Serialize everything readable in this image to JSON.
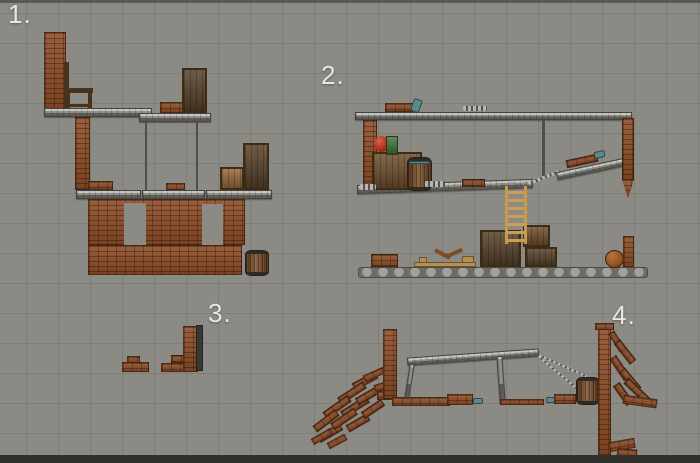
{
  "colors": {
    "background": "#8b8a85",
    "grid_line": "#807e78",
    "label_text": "#e9e7e3",
    "brick": "#8e4d27",
    "metal": "#8f8d88",
    "wood_crate": "#6f4f2d",
    "barrel_wood": "#7b4e28",
    "ladder_wood": "#c59a4e",
    "ball": "#96521f",
    "apple_red": "#a32517",
    "box_green": "#3e6c34",
    "teal_item": "#5b8a8d",
    "bottom_bar": "#32302c"
  },
  "scenes": [
    {
      "label": "1.",
      "objects": [
        {
          "t": "brick",
          "n": "brick-column",
          "x": 44,
          "y": 32,
          "w": 22,
          "h": 77
        },
        {
          "t": "chairwood",
          "n": "chair-back",
          "x": 64,
          "y": 62,
          "w": 5,
          "h": 47
        },
        {
          "t": "chairwood",
          "n": "chair-seat",
          "x": 64,
          "y": 88,
          "w": 29,
          "h": 5
        },
        {
          "t": "chairwood",
          "n": "chair-rear-leg",
          "x": 66,
          "y": 93,
          "w": 4,
          "h": 15
        },
        {
          "t": "chairwood",
          "n": "chair-front-leg",
          "x": 88,
          "y": 93,
          "w": 4,
          "h": 16
        },
        {
          "t": "chairwood",
          "n": "chair-stretcher",
          "x": 66,
          "y": 104,
          "w": 25,
          "h": 3
        },
        {
          "t": "platform",
          "n": "upper-platform-left",
          "x": 44,
          "y": 108,
          "w": 108,
          "h": 9
        },
        {
          "t": "platform",
          "n": "upper-platform-right",
          "x": 139,
          "y": 113,
          "w": 72,
          "h": 9
        },
        {
          "t": "brick",
          "n": "brick-stack",
          "x": 160,
          "y": 102,
          "w": 23,
          "h": 11
        },
        {
          "t": "crate",
          "v": "dark",
          "n": "tall-crate",
          "x": 182,
          "y": 68,
          "w": 25,
          "h": 45
        },
        {
          "t": "rope",
          "n": "hanging-rope",
          "x": 145,
          "y": 122,
          "w": 2,
          "h": 68
        },
        {
          "t": "rope",
          "n": "hanging-rope",
          "x": 196,
          "y": 122,
          "w": 2,
          "h": 68
        },
        {
          "t": "brick",
          "n": "brick-pillar",
          "x": 75,
          "y": 117,
          "w": 15,
          "h": 73
        },
        {
          "t": "brick",
          "n": "brick-arch",
          "x": 88,
          "y": 181,
          "w": 25,
          "h": 9
        },
        {
          "t": "brick",
          "n": "brick-arch",
          "x": 166,
          "y": 183,
          "w": 19,
          "h": 7
        },
        {
          "t": "platform",
          "n": "mid-platform",
          "x": 76,
          "y": 190,
          "w": 65,
          "h": 9
        },
        {
          "t": "platform",
          "n": "mid-platform",
          "x": 142,
          "y": 190,
          "w": 63,
          "h": 9
        },
        {
          "t": "platform",
          "n": "mid-platform",
          "x": 206,
          "y": 190,
          "w": 66,
          "h": 9
        },
        {
          "t": "crate",
          "v": "tan",
          "n": "crate",
          "x": 220,
          "y": 167,
          "w": 24,
          "h": 23
        },
        {
          "t": "crate",
          "v": "dark",
          "n": "crate",
          "x": 243,
          "y": 143,
          "w": 26,
          "h": 47
        },
        {
          "t": "brick",
          "n": "brick-wall",
          "x": 88,
          "y": 199,
          "w": 157,
          "h": 46
        },
        {
          "t": "window",
          "n": "window-opening",
          "x": 124,
          "y": 203,
          "w": 22,
          "h": 42
        },
        {
          "t": "window",
          "n": "window-opening",
          "x": 202,
          "y": 204,
          "w": 21,
          "h": 41
        },
        {
          "t": "brick",
          "n": "brick-wall-base",
          "x": 88,
          "y": 245,
          "w": 154,
          "h": 30
        },
        {
          "t": "barrel",
          "n": "barrel",
          "x": 245,
          "y": 250,
          "w": 24,
          "h": 26
        }
      ]
    },
    {
      "label": "2.",
      "objects": [
        {
          "t": "platform",
          "n": "top-beam",
          "x": 355,
          "y": 112,
          "w": 277,
          "h": 8
        },
        {
          "t": "brick",
          "n": "brick-stack",
          "x": 385,
          "y": 103,
          "w": 28,
          "h": 9
        },
        {
          "t": "teal",
          "n": "bottle",
          "x": 412,
          "y": 99,
          "w": 9,
          "h": 13,
          "r": 20
        },
        {
          "t": "chain",
          "n": "chain",
          "x": 463,
          "y": 106,
          "w": 24,
          "h": 5
        },
        {
          "t": "brick",
          "n": "hanging-brick-column",
          "x": 363,
          "y": 120,
          "w": 14,
          "h": 69
        },
        {
          "t": "rope",
          "n": "hanging-rope",
          "x": 542,
          "y": 120,
          "w": 3,
          "h": 56
        },
        {
          "t": "platform",
          "n": "shelf-beam",
          "x": 357,
          "y": 182,
          "w": 176,
          "h": 9,
          "r": -2
        },
        {
          "t": "crate",
          "n": "crate-large",
          "x": 372,
          "y": 152,
          "w": 50,
          "h": 38
        },
        {
          "t": "barrel",
          "n": "barrel",
          "x": 407,
          "y": 157,
          "w": 25,
          "h": 34
        },
        {
          "t": "teal",
          "n": "barrel-band",
          "x": 409,
          "y": 161,
          "w": 21,
          "h": 3
        },
        {
          "t": "apple",
          "n": "apple",
          "x": 374,
          "y": 136,
          "w": 15,
          "h": 16
        },
        {
          "t": "greenbox",
          "n": "green-box",
          "x": 386,
          "y": 136,
          "w": 12,
          "h": 19
        },
        {
          "t": "brick",
          "n": "brick-stack",
          "x": 462,
          "y": 179,
          "w": 23,
          "h": 8
        },
        {
          "t": "chain",
          "n": "chain",
          "x": 360,
          "y": 184,
          "w": 16,
          "h": 6
        },
        {
          "t": "chain",
          "n": "chain",
          "x": 425,
          "y": 181,
          "w": 20,
          "h": 6
        },
        {
          "t": "chain",
          "n": "chain-link",
          "x": 527,
          "y": 176,
          "w": 34,
          "h": 3,
          "r": -22
        },
        {
          "t": "platform",
          "n": "ramp-beam",
          "x": 556,
          "y": 165,
          "w": 70,
          "h": 8,
          "r": -12
        },
        {
          "t": "brick",
          "n": "ramp-bricks",
          "x": 566,
          "y": 157,
          "w": 32,
          "h": 8,
          "r": -12
        },
        {
          "t": "teal",
          "n": "bottle",
          "x": 594,
          "y": 151,
          "w": 11,
          "h": 7,
          "r": -12
        },
        {
          "t": "brick",
          "n": "hanging-brick-column",
          "x": 622,
          "y": 118,
          "w": 12,
          "h": 62
        },
        {
          "t": "tip",
          "n": "brick-tip",
          "x": 622,
          "y": 180,
          "w": 12,
          "h": 18
        },
        {
          "t": "stone",
          "n": "ground",
          "x": 358,
          "y": 267,
          "w": 290,
          "h": 11
        },
        {
          "t": "brick",
          "n": "brick-stack",
          "x": 371,
          "y": 254,
          "w": 27,
          "h": 13
        },
        {
          "t": "wood",
          "n": "plank",
          "x": 414,
          "y": 262,
          "w": 62,
          "h": 5
        },
        {
          "t": "stick",
          "n": "wood-stick",
          "x": 434,
          "y": 252,
          "w": 17,
          "h": 4,
          "r": 28
        },
        {
          "t": "stick",
          "n": "wood-stick",
          "x": 446,
          "y": 251,
          "w": 17,
          "h": 4,
          "r": -24
        },
        {
          "t": "wood",
          "n": "small-box",
          "x": 462,
          "y": 256,
          "w": 12,
          "h": 7
        },
        {
          "t": "wood",
          "n": "small-box",
          "x": 419,
          "y": 257,
          "w": 8,
          "h": 6
        },
        {
          "t": "crate",
          "v": "dark",
          "n": "crate",
          "x": 480,
          "y": 230,
          "w": 41,
          "h": 37
        },
        {
          "t": "crate",
          "n": "crate",
          "x": 523,
          "y": 225,
          "w": 27,
          "h": 22
        },
        {
          "t": "crate",
          "v": "dark",
          "n": "crate",
          "x": 525,
          "y": 247,
          "w": 32,
          "h": 20
        },
        {
          "t": "ladder",
          "n": "ladder",
          "x": 505,
          "y": 186,
          "w": 22,
          "h": 58
        },
        {
          "t": "ball",
          "n": "ball",
          "x": 605,
          "y": 250,
          "w": 19,
          "h": 18
        },
        {
          "t": "brick",
          "n": "brick-column",
          "x": 623,
          "y": 236,
          "w": 11,
          "h": 31
        }
      ]
    },
    {
      "label": "3.",
      "objects": [
        {
          "t": "brick",
          "n": "brick-rubble",
          "x": 122,
          "y": 362,
          "w": 27,
          "h": 10
        },
        {
          "t": "brick",
          "n": "brick-rubble",
          "x": 127,
          "y": 356,
          "w": 13,
          "h": 7
        },
        {
          "t": "brick",
          "n": "brick-base",
          "x": 161,
          "y": 363,
          "w": 37,
          "h": 9
        },
        {
          "t": "brick",
          "n": "brick-step",
          "x": 171,
          "y": 355,
          "w": 26,
          "h": 8
        },
        {
          "t": "brick",
          "n": "brick-column",
          "x": 183,
          "y": 326,
          "w": 14,
          "h": 46
        },
        {
          "t": "metalbar",
          "n": "metal-beam",
          "x": 196,
          "y": 325,
          "w": 7,
          "h": 46
        }
      ]
    },
    {
      "label": "4.",
      "objects": [
        {
          "t": "brick",
          "n": "rubble-brick",
          "x": 352,
          "y": 377,
          "w": 26,
          "h": 8,
          "r": -28
        },
        {
          "t": "brick",
          "n": "rubble-brick",
          "x": 337,
          "y": 389,
          "w": 30,
          "h": 8,
          "r": -33
        },
        {
          "t": "brick",
          "n": "rubble-brick",
          "x": 322,
          "y": 403,
          "w": 30,
          "h": 8,
          "r": -35
        },
        {
          "t": "brick",
          "n": "rubble-brick",
          "x": 312,
          "y": 417,
          "w": 28,
          "h": 8,
          "r": -37
        },
        {
          "t": "brick",
          "n": "rubble-brick",
          "x": 317,
          "y": 429,
          "w": 26,
          "h": 8,
          "r": -30
        },
        {
          "t": "brick",
          "n": "rubble-brick",
          "x": 340,
          "y": 403,
          "w": 30,
          "h": 8,
          "r": -32
        },
        {
          "t": "brick",
          "n": "rubble-brick",
          "x": 355,
          "y": 391,
          "w": 28,
          "h": 8,
          "r": -30
        },
        {
          "t": "brick",
          "n": "rubble-brick",
          "x": 330,
          "y": 415,
          "w": 28,
          "h": 8,
          "r": -34
        },
        {
          "t": "brick",
          "n": "rubble-brick",
          "x": 346,
          "y": 419,
          "w": 24,
          "h": 8,
          "r": -30
        },
        {
          "t": "brick",
          "n": "rubble-brick",
          "x": 361,
          "y": 405,
          "w": 24,
          "h": 8,
          "r": -34
        },
        {
          "t": "brick",
          "n": "rubble-brick",
          "x": 311,
          "y": 433,
          "w": 22,
          "h": 7,
          "r": -30
        },
        {
          "t": "brick",
          "n": "rubble-brick",
          "x": 327,
          "y": 438,
          "w": 20,
          "h": 7,
          "r": -28
        },
        {
          "t": "brick",
          "n": "rubble-brick",
          "x": 363,
          "y": 371,
          "w": 22,
          "h": 7,
          "r": -24
        },
        {
          "t": "brick",
          "n": "rubble-brick",
          "x": 374,
          "y": 382,
          "w": 20,
          "h": 7,
          "r": -18
        },
        {
          "t": "brick",
          "n": "tower-base",
          "x": 377,
          "y": 391,
          "w": 20,
          "h": 9
        },
        {
          "t": "brick",
          "n": "brick-tower",
          "x": 383,
          "y": 329,
          "w": 14,
          "h": 70
        },
        {
          "t": "brick",
          "n": "ground-bricks",
          "x": 392,
          "y": 397,
          "w": 58,
          "h": 9
        },
        {
          "t": "brick",
          "n": "ground-bricks",
          "x": 447,
          "y": 394,
          "w": 26,
          "h": 11
        },
        {
          "t": "teal",
          "n": "bottle",
          "x": 473,
          "y": 398,
          "w": 10,
          "h": 6
        },
        {
          "t": "platform",
          "n": "bridge-beam",
          "x": 407,
          "y": 353,
          "w": 132,
          "h": 8,
          "r": -4
        },
        {
          "t": "platform",
          "n": "bridge-leg",
          "x": 407,
          "y": 364,
          "w": 5,
          "h": 34,
          "r": 9
        },
        {
          "t": "platform",
          "n": "bridge-leg",
          "x": 498,
          "y": 356,
          "w": 6,
          "h": 47,
          "r": -4
        },
        {
          "t": "brick",
          "n": "ground-bricks",
          "x": 500,
          "y": 399,
          "w": 44,
          "h": 6
        },
        {
          "t": "teal",
          "n": "bottle",
          "x": 546,
          "y": 397,
          "w": 9,
          "h": 6
        },
        {
          "t": "brick",
          "n": "ground-bricks",
          "x": 554,
          "y": 394,
          "w": 22,
          "h": 10
        },
        {
          "t": "chain",
          "n": "rope",
          "x": 537,
          "y": 365,
          "w": 52,
          "h": 2,
          "r": 24
        },
        {
          "t": "chain",
          "n": "rope",
          "x": 532,
          "y": 373,
          "w": 55,
          "h": 2,
          "r": 40
        },
        {
          "t": "barrel",
          "n": "barrel",
          "x": 576,
          "y": 377,
          "w": 24,
          "h": 28
        },
        {
          "t": "brick",
          "n": "brick-wall",
          "x": 598,
          "y": 328,
          "w": 13,
          "h": 128
        },
        {
          "t": "brick",
          "n": "wall-cap",
          "x": 595,
          "y": 323,
          "w": 19,
          "h": 7
        },
        {
          "t": "brick",
          "n": "spill-brick",
          "x": 606,
          "y": 338,
          "w": 22,
          "h": 7,
          "r": 58
        },
        {
          "t": "brick",
          "n": "spill-brick",
          "x": 612,
          "y": 348,
          "w": 26,
          "h": 8,
          "r": 52
        },
        {
          "t": "brick",
          "n": "spill-brick",
          "x": 607,
          "y": 364,
          "w": 26,
          "h": 8,
          "r": 56
        },
        {
          "t": "brick",
          "n": "spill-brick",
          "x": 617,
          "y": 376,
          "w": 26,
          "h": 8,
          "r": 50
        },
        {
          "t": "brick",
          "n": "spill-brick",
          "x": 611,
          "y": 390,
          "w": 24,
          "h": 8,
          "r": 55
        },
        {
          "t": "brick",
          "n": "spill-brick",
          "x": 622,
          "y": 387,
          "w": 30,
          "h": 8,
          "r": 44
        },
        {
          "t": "brick",
          "n": "spill-brick",
          "x": 623,
          "y": 397,
          "w": 34,
          "h": 9,
          "r": 8
        },
        {
          "t": "brick",
          "n": "spill-brick",
          "x": 609,
          "y": 440,
          "w": 26,
          "h": 10,
          "r": -10
        },
        {
          "t": "brick",
          "n": "spill-brick",
          "x": 617,
          "y": 449,
          "w": 20,
          "h": 8,
          "r": 4
        }
      ]
    }
  ]
}
